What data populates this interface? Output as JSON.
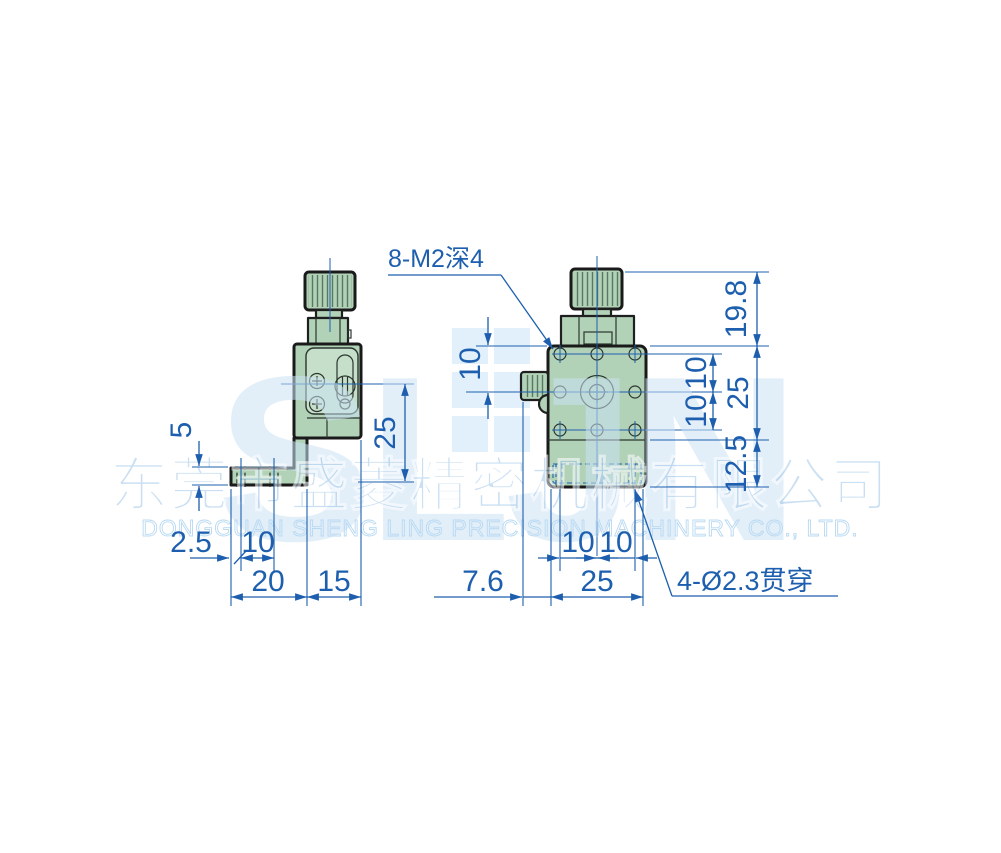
{
  "watermark": {
    "logo": "SLJN",
    "company_cn": "东莞市盛菱精密机械有限公司",
    "company_en": "DONGGUAN SHENG LING PRECISION MACHINERY CO., LTD."
  },
  "callouts": {
    "thread": "8-M2深4",
    "through_hole": "4-Ø2.3贯穿"
  },
  "left_view": {
    "dims": {
      "foot_thickness": "5",
      "center_height": "25",
      "edge_to_hole": "2.5",
      "hole_pitch": "10",
      "foot_length": "20",
      "body_depth": "15"
    }
  },
  "right_view": {
    "dims": {
      "knob_height": "19.8",
      "top_to_axis": "10",
      "pitch_upper": "10",
      "pitch_lower": "10",
      "stage_height": "25",
      "base_height": "12.5",
      "knob_protrusion": "7.6",
      "pitch_left": "10",
      "pitch_right": "10",
      "body_width": "25"
    }
  },
  "colors": {
    "dimension_blue": "#1d5fae",
    "part_green": "#b2d2b8",
    "outline": "#1a1a1a",
    "watermark_blue": "#cbe3f5"
  }
}
